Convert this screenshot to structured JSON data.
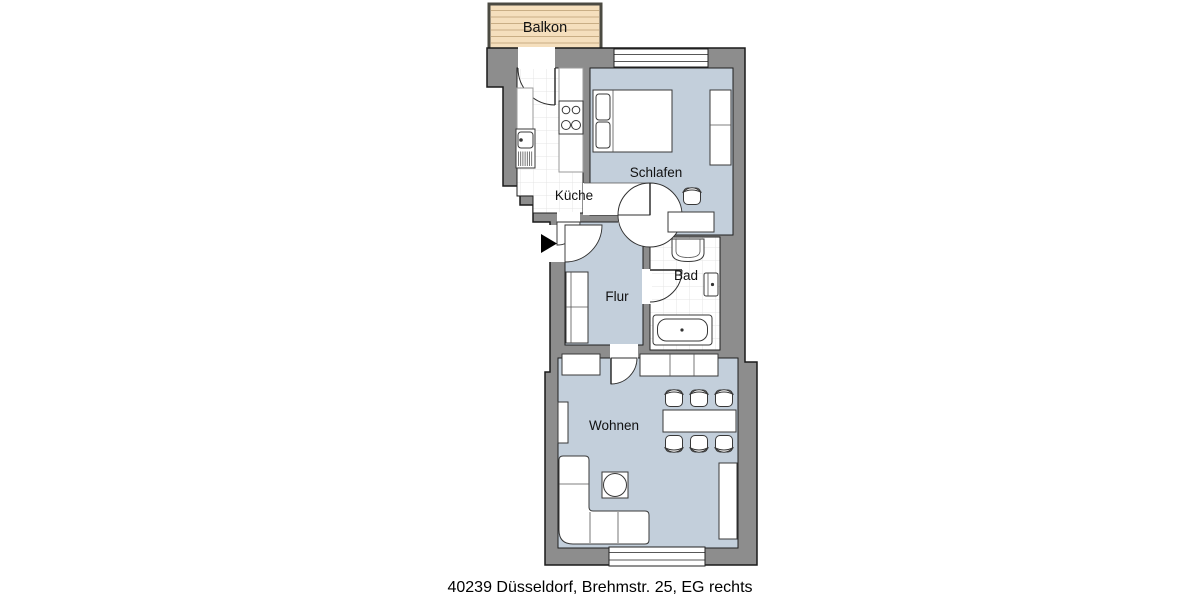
{
  "plan": {
    "caption": "40239 Düsseldorf, Brehmstr. 25, EG rechts",
    "rooms": {
      "balkon": {
        "label": "Balkon"
      },
      "kueche": {
        "label": "Küche"
      },
      "schlafen": {
        "label": "Schlafen"
      },
      "bad": {
        "label": "Bad"
      },
      "flur": {
        "label": "Flur"
      },
      "wohnen": {
        "label": "Wohnen"
      }
    },
    "icons": {
      "entrance": "entrance-arrow-icon"
    },
    "colors": {
      "wall": "#8d8d8d",
      "outline": "#1f1f1f",
      "room_floor": "#c3cfdb",
      "wet_floor": "#ffffff",
      "tile_line": "#e4e4e4",
      "balcony_floor": "#f5dfbd",
      "balcony_plank_line": "#c9ae85",
      "balcony_border": "#4b4a42",
      "marker": "#000000"
    }
  }
}
